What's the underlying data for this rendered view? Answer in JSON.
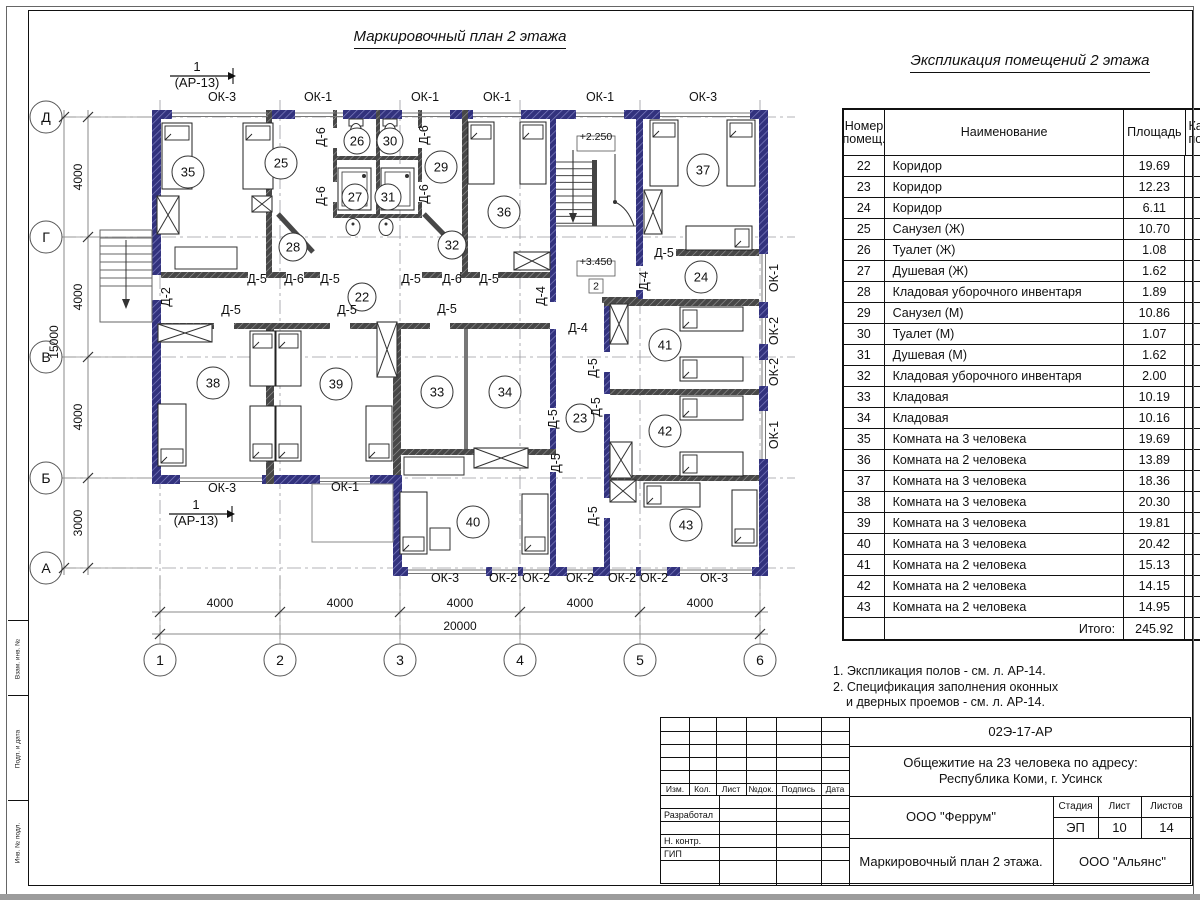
{
  "sheet": {
    "plan_title": "Маркировочный план 2 этажа",
    "table_title": "Экспликация помещений 2 этажа",
    "notes": [
      "1. Экспликация полов - см. л. АР-14.",
      "2. Спецификация заполнения оконных",
      "и дверных проемов - см. л. АР-14."
    ]
  },
  "table": {
    "header_num": "Номер помещ.",
    "header_name": "Наименование",
    "header_area": "Площадь",
    "header_cat_line1": "Ка",
    "header_cat_line2": "по",
    "rows": [
      [
        "22",
        "Коридор",
        "19.69"
      ],
      [
        "23",
        "Коридор",
        "12.23"
      ],
      [
        "24",
        "Коридор",
        "6.11"
      ],
      [
        "25",
        "Санузел (Ж)",
        "10.70"
      ],
      [
        "26",
        "Туалет (Ж)",
        "1.08"
      ],
      [
        "27",
        "Душевая (Ж)",
        "1.62"
      ],
      [
        "28",
        "Кладовая уборочного инвентаря",
        "1.89"
      ],
      [
        "29",
        "Санузел (М)",
        "10.86"
      ],
      [
        "30",
        "Туалет (М)",
        "1.07"
      ],
      [
        "31",
        "Душевая (М)",
        "1.62"
      ],
      [
        "32",
        "Кладовая уборочного инвентаря",
        "2.00"
      ],
      [
        "33",
        "Кладовая",
        "10.19"
      ],
      [
        "34",
        "Кладовая",
        "10.16"
      ],
      [
        "35",
        "Комната на 3 человека",
        "19.69"
      ],
      [
        "36",
        "Комната на 2 человека",
        "13.89"
      ],
      [
        "37",
        "Комната на 3 человека",
        "18.36"
      ],
      [
        "38",
        "Комната на 3 человека",
        "20.30"
      ],
      [
        "39",
        "Комната на 3 человека",
        "19.81"
      ],
      [
        "40",
        "Комната на 3 человека",
        "20.42"
      ],
      [
        "41",
        "Комната на 2 человека",
        "15.13"
      ],
      [
        "42",
        "Комната на 2 человека",
        "14.15"
      ],
      [
        "43",
        "Комната на 2 человека",
        "14.95"
      ]
    ],
    "total_label": "Итого:",
    "total_value": "245.92"
  },
  "plan": {
    "rooms": [
      {
        "n": "35",
        "x": 188,
        "y": 172
      },
      {
        "n": "25",
        "x": 281,
        "y": 163
      },
      {
        "n": "26",
        "x": 357,
        "y": 141,
        "r": 13
      },
      {
        "n": "30",
        "x": 390,
        "y": 141,
        "r": 13
      },
      {
        "n": "27",
        "x": 355,
        "y": 197,
        "r": 13
      },
      {
        "n": "31",
        "x": 388,
        "y": 197,
        "r": 13
      },
      {
        "n": "29",
        "x": 441,
        "y": 167
      },
      {
        "n": "36",
        "x": 504,
        "y": 212
      },
      {
        "n": "37",
        "x": 703,
        "y": 170
      },
      {
        "n": "28",
        "x": 293,
        "y": 247,
        "r": 14
      },
      {
        "n": "32",
        "x": 452,
        "y": 245,
        "r": 14
      },
      {
        "n": "22",
        "x": 362,
        "y": 297,
        "r": 14
      },
      {
        "n": "24",
        "x": 701,
        "y": 277
      },
      {
        "n": "38",
        "x": 213,
        "y": 383
      },
      {
        "n": "39",
        "x": 336,
        "y": 384
      },
      {
        "n": "33",
        "x": 437,
        "y": 392
      },
      {
        "n": "34",
        "x": 505,
        "y": 392
      },
      {
        "n": "23",
        "x": 580,
        "y": 418,
        "r": 14
      },
      {
        "n": "41",
        "x": 665,
        "y": 345
      },
      {
        "n": "42",
        "x": 665,
        "y": 431
      },
      {
        "n": "40",
        "x": 473,
        "y": 522
      },
      {
        "n": "43",
        "x": 686,
        "y": 525
      }
    ],
    "door_labels": [
      {
        "t": "Д-6",
        "x": 325,
        "y": 137,
        "rot": -90
      },
      {
        "t": "Д-6",
        "x": 325,
        "y": 196,
        "rot": -90
      },
      {
        "t": "Д-6",
        "x": 428,
        "y": 135,
        "rot": -90
      },
      {
        "t": "Д-6",
        "x": 428,
        "y": 194,
        "rot": -90
      },
      {
        "t": "Д-5",
        "x": 257,
        "y": 283
      },
      {
        "t": "Д-6",
        "x": 294,
        "y": 283
      },
      {
        "t": "Д-5",
        "x": 330,
        "y": 283
      },
      {
        "t": "Д-5",
        "x": 411,
        "y": 283
      },
      {
        "t": "Д-6",
        "x": 452,
        "y": 283
      },
      {
        "t": "Д-5",
        "x": 489,
        "y": 283
      },
      {
        "t": "Д-5",
        "x": 231,
        "y": 314
      },
      {
        "t": "Д-5",
        "x": 347,
        "y": 314
      },
      {
        "t": "Д-5",
        "x": 447,
        "y": 313
      },
      {
        "t": "Д-2",
        "x": 170,
        "y": 297,
        "rot": -90
      },
      {
        "t": "Д-4",
        "x": 545,
        "y": 296,
        "rot": -90
      },
      {
        "t": "Д-4",
        "x": 578,
        "y": 332
      },
      {
        "t": "Д-5",
        "x": 664,
        "y": 257
      },
      {
        "t": "Д-4",
        "x": 648,
        "y": 281,
        "rot": -90
      },
      {
        "t": "Д-5",
        "x": 597,
        "y": 368,
        "rot": -90
      },
      {
        "t": "Д-5",
        "x": 557,
        "y": 419,
        "rot": -90
      },
      {
        "t": "Д-5",
        "x": 600,
        "y": 407,
        "rot": -90
      },
      {
        "t": "Д-5",
        "x": 560,
        "y": 463,
        "rot": -90
      },
      {
        "t": "Д-5",
        "x": 597,
        "y": 516,
        "rot": -90
      }
    ],
    "window_labels": [
      {
        "t": "ОК-3",
        "x": 222,
        "y": 101
      },
      {
        "t": "ОК-1",
        "x": 318,
        "y": 101
      },
      {
        "t": "ОК-1",
        "x": 425,
        "y": 101
      },
      {
        "t": "ОК-1",
        "x": 497,
        "y": 101
      },
      {
        "t": "ОК-1",
        "x": 600,
        "y": 101
      },
      {
        "t": "ОК-3",
        "x": 703,
        "y": 101
      },
      {
        "t": "ОК-3",
        "x": 222,
        "y": 492
      },
      {
        "t": "ОК-1",
        "x": 345,
        "y": 491
      },
      {
        "t": "ОК-3",
        "x": 445,
        "y": 582
      },
      {
        "t": "ОК-2",
        "x": 503,
        "y": 582
      },
      {
        "t": "ОК-2",
        "x": 536,
        "y": 582
      },
      {
        "t": "ОК-2",
        "x": 580,
        "y": 582
      },
      {
        "t": "ОК-2",
        "x": 622,
        "y": 582
      },
      {
        "t": "ОК-2",
        "x": 654,
        "y": 582
      },
      {
        "t": "ОК-3",
        "x": 714,
        "y": 582
      },
      {
        "t": "ОК-1",
        "x": 778,
        "y": 278,
        "rot": -90
      },
      {
        "t": "ОК-2",
        "x": 778,
        "y": 331,
        "rot": -90
      },
      {
        "t": "ОК-2",
        "x": 778,
        "y": 372,
        "rot": -90
      },
      {
        "t": "ОК-1",
        "x": 778,
        "y": 435,
        "rot": -90
      }
    ],
    "axes_left": [
      {
        "label": "Д",
        "y": 117
      },
      {
        "label": "Г",
        "y": 237
      },
      {
        "label": "В",
        "y": 357
      },
      {
        "label": "Б",
        "y": 478
      },
      {
        "label": "А",
        "y": 568
      }
    ],
    "axes_bottom": [
      {
        "label": "1",
        "x": 160
      },
      {
        "label": "2",
        "x": 280
      },
      {
        "label": "3",
        "x": 400
      },
      {
        "label": "4",
        "x": 520
      },
      {
        "label": "5",
        "x": 640
      },
      {
        "label": "6",
        "x": 760
      }
    ],
    "dims_left": [
      {
        "t": "4000",
        "y": 177
      },
      {
        "t": "4000",
        "y": 297
      },
      {
        "t": "4000",
        "y": 417
      },
      {
        "t": "3000",
        "y": 523
      }
    ],
    "dim_left_total": "15000",
    "dims_bottom": [
      {
        "t": "4000",
        "x": 220
      },
      {
        "t": "4000",
        "x": 340
      },
      {
        "t": "4000",
        "x": 460
      },
      {
        "t": "4000",
        "x": 580
      },
      {
        "t": "4000",
        "x": 700
      }
    ],
    "dim_bottom_total": "20000",
    "elevations": [
      {
        "t": "+2.250",
        "x": 596,
        "y": 147
      },
      {
        "t": "+3.450",
        "x": 596,
        "y": 272
      }
    ],
    "level_mark": "2",
    "section_marks": [
      {
        "num": "1",
        "ref": "(АР-13)",
        "x": 197,
        "y": 71
      },
      {
        "num": "1",
        "ref": "(АР-13)",
        "x": 196,
        "y": 509
      }
    ]
  },
  "stamp": {
    "doc_number": "02Э-17-АР",
    "project_line1": "Общежитие на 23 человека по адресу:",
    "project_line2": "Республика Коми, г. Усинск",
    "designer_org": "ООО \"Феррум\"",
    "drawing_name": "Маркировочный план 2 этажа.",
    "client_org": "ООО \"Альянс\"",
    "stage_label": "Стадия",
    "stage": "ЭП",
    "sheet_label": "Лист",
    "sheet": "10",
    "sheets_label": "Листов",
    "sheets": "14",
    "rev_headers": [
      "Изм.",
      "Кол.",
      "Лист",
      "№док.",
      "Подпись",
      "Дата"
    ],
    "roles": [
      "Разработал",
      "Н. контр.",
      "ГИП"
    ]
  },
  "side_stamp": [
    "Взам. инв. №",
    "Подп. и дата",
    "Инв. № подл."
  ]
}
